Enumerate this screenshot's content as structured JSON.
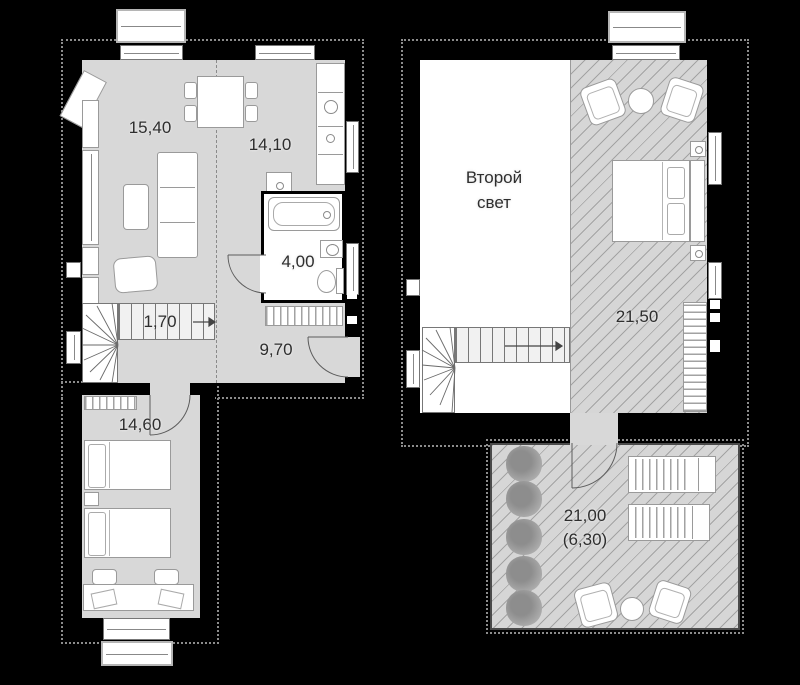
{
  "title": "Two-level apartment floor plan",
  "colors": {
    "background": "#000000",
    "walls": "#000000",
    "floor_gray": "#d8d8d8",
    "floor_white": "#ffffff",
    "hatch_base": "#d6d6d6",
    "furniture": "#ffffff",
    "label_text": "#2e2e2e",
    "speckle_outline": "#8c8c8c"
  },
  "floor1": {
    "living": {
      "area_label": "15,40"
    },
    "kitchen": {
      "area_label": "14,10"
    },
    "bathroom": {
      "area_label": "4,00"
    },
    "stairs": {
      "area_label": "1,70"
    },
    "hallway": {
      "area_label": "9,70"
    },
    "bedroom": {
      "area_label": "14,60"
    }
  },
  "floor2": {
    "void": {
      "label_line1": "Второй",
      "label_line2": "свет"
    },
    "bedroom": {
      "area_label": "21,50"
    },
    "terrace": {
      "area_label": "21,00",
      "area_label_secondary": "(6,30)"
    }
  }
}
